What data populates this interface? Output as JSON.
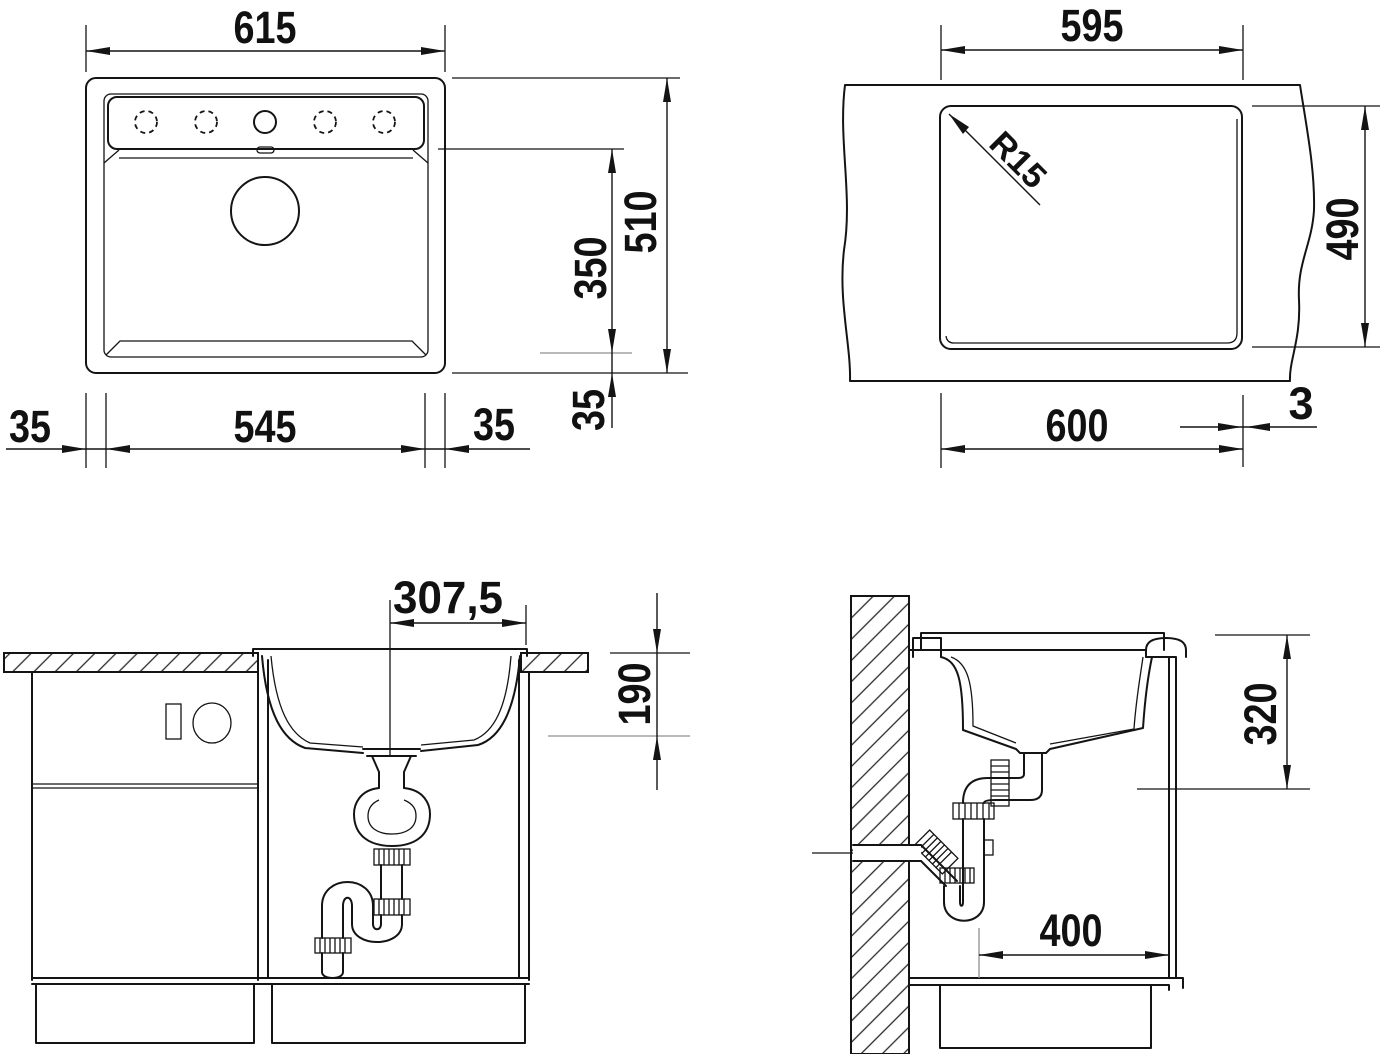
{
  "drawing": {
    "type": "sink installation technical drawing",
    "background_color": "#ffffff",
    "line_color": "#141414",
    "aux_line_color": "#8f8f8f",
    "views": {
      "top_view": {
        "title": "sink top view",
        "dims": {
          "overall_width": "615",
          "overall_depth": "510",
          "bowl_inner_depth": "350",
          "bowl_front_offset": "35",
          "bowl_width": "545",
          "bowl_left_offset": "35",
          "bowl_right_offset": "35"
        }
      },
      "cutout_view": {
        "title": "worktop cutout view",
        "dims": {
          "cutout_width": "595",
          "cutout_depth": "490",
          "min_cabinet_width": "600",
          "rear_edge_gap": "3",
          "corner_radius": "R15"
        }
      },
      "front_section": {
        "title": "front section view",
        "dims": {
          "drain_centerline_offset": "307,5",
          "bowl_depth": "190"
        }
      },
      "side_section": {
        "title": "side section view",
        "dims": {
          "clearance_height": "320",
          "min_cabinet_depth": "400"
        }
      }
    }
  }
}
